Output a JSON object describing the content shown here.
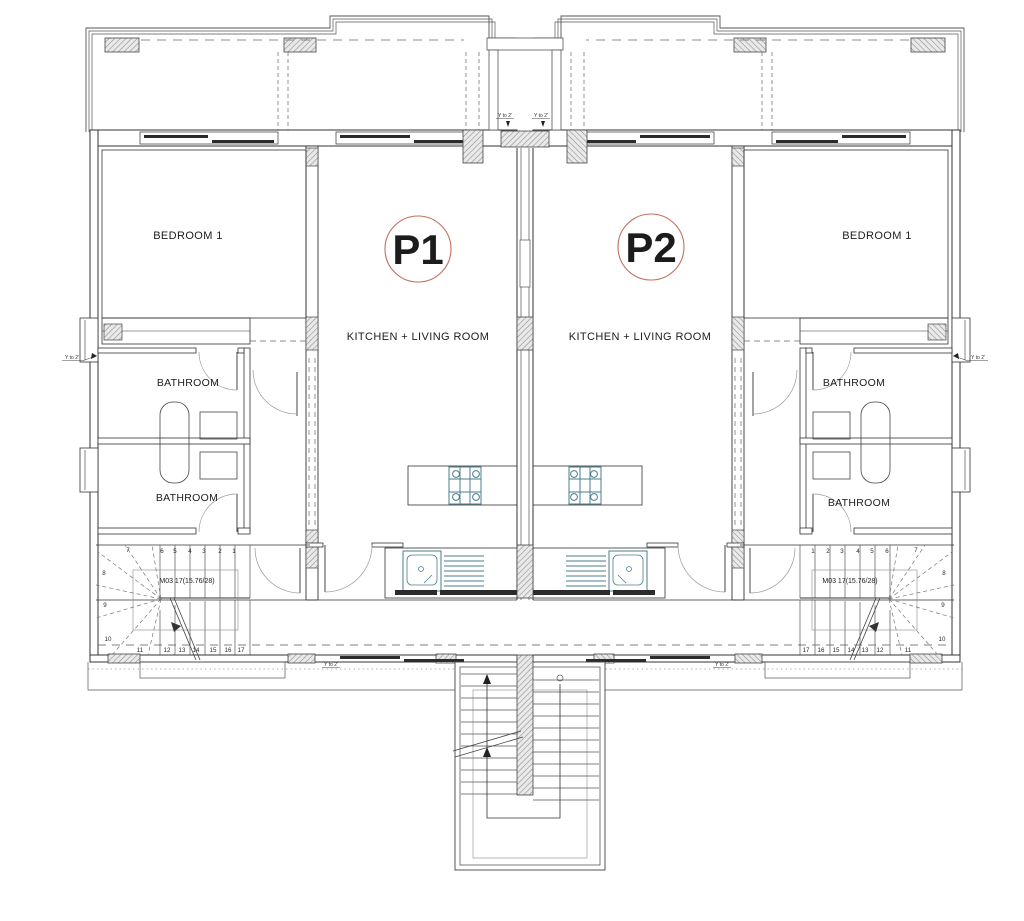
{
  "plan_type": "floor-plan",
  "colors": {
    "accent_red": "#e32b1e",
    "circle_stroke": "#c3705f",
    "fixture_teal": "#4a7d8c",
    "wall_line": "#333333",
    "hatch_gray": "#8a8a8a",
    "glazing_dark": "#2b2b2b"
  },
  "units": [
    {
      "id": "P1",
      "kitchen_label": "KITCHEN + LIVING ROOM",
      "bedroom_label": "BEDROOM 1",
      "bathroom_upper_label": "BATHROOM",
      "bathroom_lower_label": "BATHROOM",
      "stair_label": "M03 17(15.76/28)"
    },
    {
      "id": "P2",
      "kitchen_label": "KITCHEN + LIVING ROOM",
      "bedroom_label": "BEDROOM 1",
      "bathroom_upper_label": "BATHROOM",
      "bathroom_lower_label": "BATHROOM",
      "stair_label": "M03 17(15.76/28)"
    }
  ],
  "stair_numbers": [
    "1",
    "2",
    "3",
    "4",
    "5",
    "6",
    "7",
    "8",
    "9",
    "10",
    "11",
    "12",
    "13",
    "14",
    "15",
    "16",
    "17"
  ],
  "markers": {
    "step_label": "Y to 2'"
  }
}
